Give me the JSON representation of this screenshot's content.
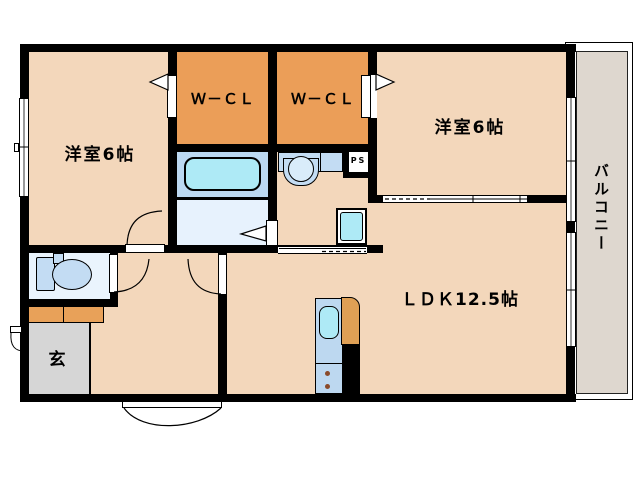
{
  "labels": {
    "bedroom_left": "洋室6帖",
    "bedroom_right": "洋室6帖",
    "closet_left": "Ｗ－ＣＬ",
    "closet_right": "Ｗ－ＣＬ",
    "living": "ＬＤＫ12.5帖",
    "entrance": "玄",
    "balcony": "バルコニー",
    "pipe_space": "PS"
  },
  "rooms": [
    {
      "name": "bedroom-left",
      "label": "洋室6帖",
      "size_tatami": 6
    },
    {
      "name": "bedroom-right",
      "label": "洋室6帖",
      "size_tatami": 6
    },
    {
      "name": "walk-in-closet-left",
      "label": "Ｗ－ＣＬ"
    },
    {
      "name": "walk-in-closet-right",
      "label": "Ｗ－ＣＬ"
    },
    {
      "name": "living-dining-kitchen",
      "label": "ＬＤＫ12.5帖",
      "size_tatami": 12.5
    },
    {
      "name": "entrance",
      "label": "玄"
    },
    {
      "name": "balcony",
      "label": "バルコニー"
    },
    {
      "name": "pipe-space",
      "label": "PS"
    }
  ],
  "colors": {
    "wall": "#000000",
    "room_floor": "#f3d7bb",
    "closet_floor": "#eb9e58",
    "bathroom_floor": "#bcd9f2",
    "washroom_floor": "#e7f2fd",
    "toilet_floor": "#eaf4fd",
    "fixture_blue": "#c3dcf3",
    "water_cyan": "#aeeaf6",
    "kitchen_blue": "#bdd8f0",
    "entrance_gray": "#d6d6d6",
    "balcony_gray": "#ded7cf",
    "cabinet_orange": "#e8a159",
    "burner_brown": "#8a4a2a"
  }
}
